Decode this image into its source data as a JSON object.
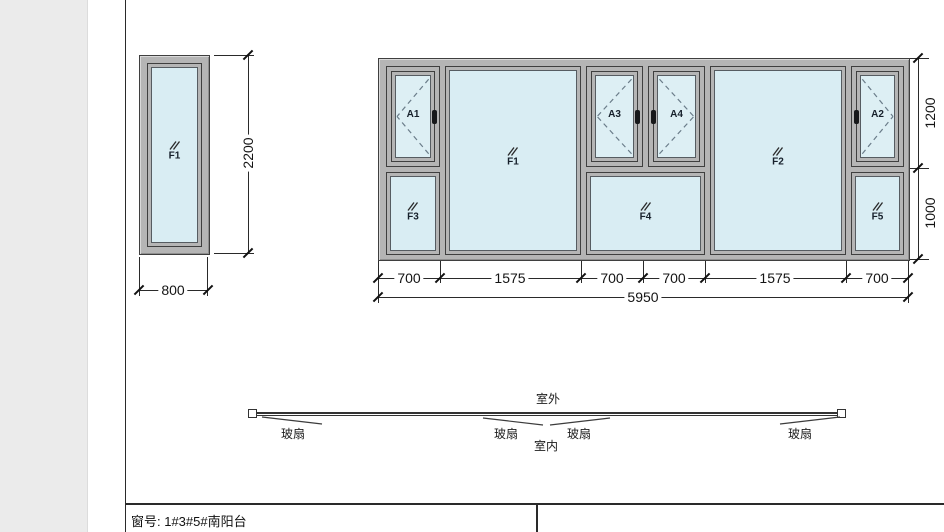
{
  "left_window": {
    "panel_label": "F1",
    "width_dim": "800",
    "height_dim": "2200"
  },
  "assembly": {
    "panel_labels": {
      "a1": "A1",
      "a3": "A3",
      "a4": "A4",
      "a2": "A2",
      "f1": "F1",
      "f2": "F2",
      "f3": "F3",
      "f4": "F4",
      "f5": "F5"
    },
    "segment_dims": [
      "700",
      "1575",
      "700",
      "700",
      "1575",
      "700"
    ],
    "total_width_dim": "5950",
    "height_dims": {
      "top": "1200",
      "bottom": "1000"
    }
  },
  "plan_view": {
    "outside_label": "室外",
    "inside_label": "室内",
    "sash_labels": [
      "玻扇",
      "玻扇",
      "玻扇",
      "玻扇"
    ]
  },
  "title_block": {
    "window_label": "窗号: 1#3#5#南阳台"
  },
  "colors": {
    "glass": "#d9edf3",
    "frame": "#b5b5b5",
    "frame_edge": "#3f3f3f",
    "dash": "#6b7d8a",
    "line": "#2a2a2a",
    "gutter": "#ebebeb"
  }
}
